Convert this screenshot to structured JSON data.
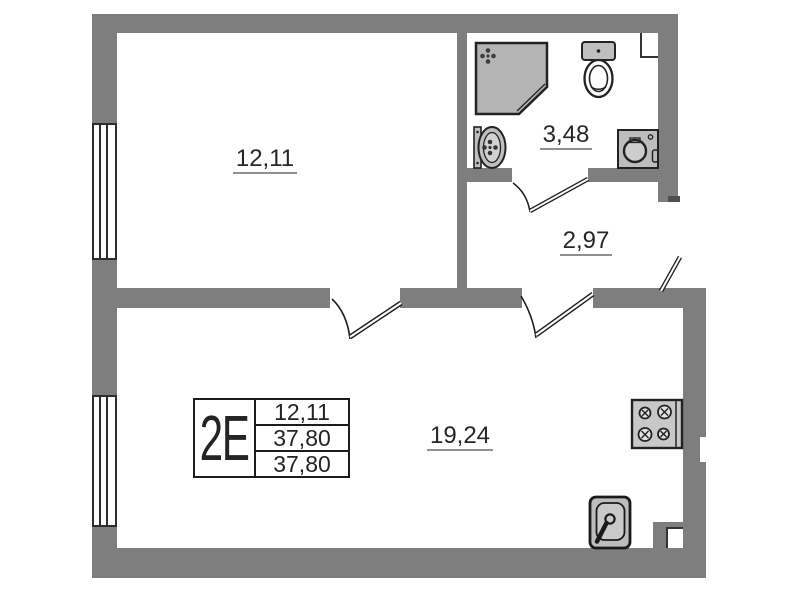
{
  "plan": {
    "type": "apartment-floor-plan",
    "unit_label": "2E",
    "rooms": [
      {
        "name": "room",
        "area": "12,11"
      },
      {
        "name": "bathroom",
        "area": "3,48"
      },
      {
        "name": "hallway",
        "area": "2,97"
      },
      {
        "name": "living-kitchen",
        "area": "19,24"
      }
    ],
    "info_box": {
      "unit": "2E",
      "rows": [
        "12,11",
        "37,80",
        "37,80"
      ]
    },
    "fixtures": [
      "shower",
      "toilet",
      "washbasin",
      "washing-machine",
      "stove",
      "kitchen-sink",
      "vent-shaft"
    ],
    "colors": {
      "wall": "#7e7e7e",
      "fixture_fill": "#bdbdbd",
      "stove_fill": "#c8c8c8",
      "outline": "#1f1f1f",
      "underline": "#909090"
    }
  }
}
